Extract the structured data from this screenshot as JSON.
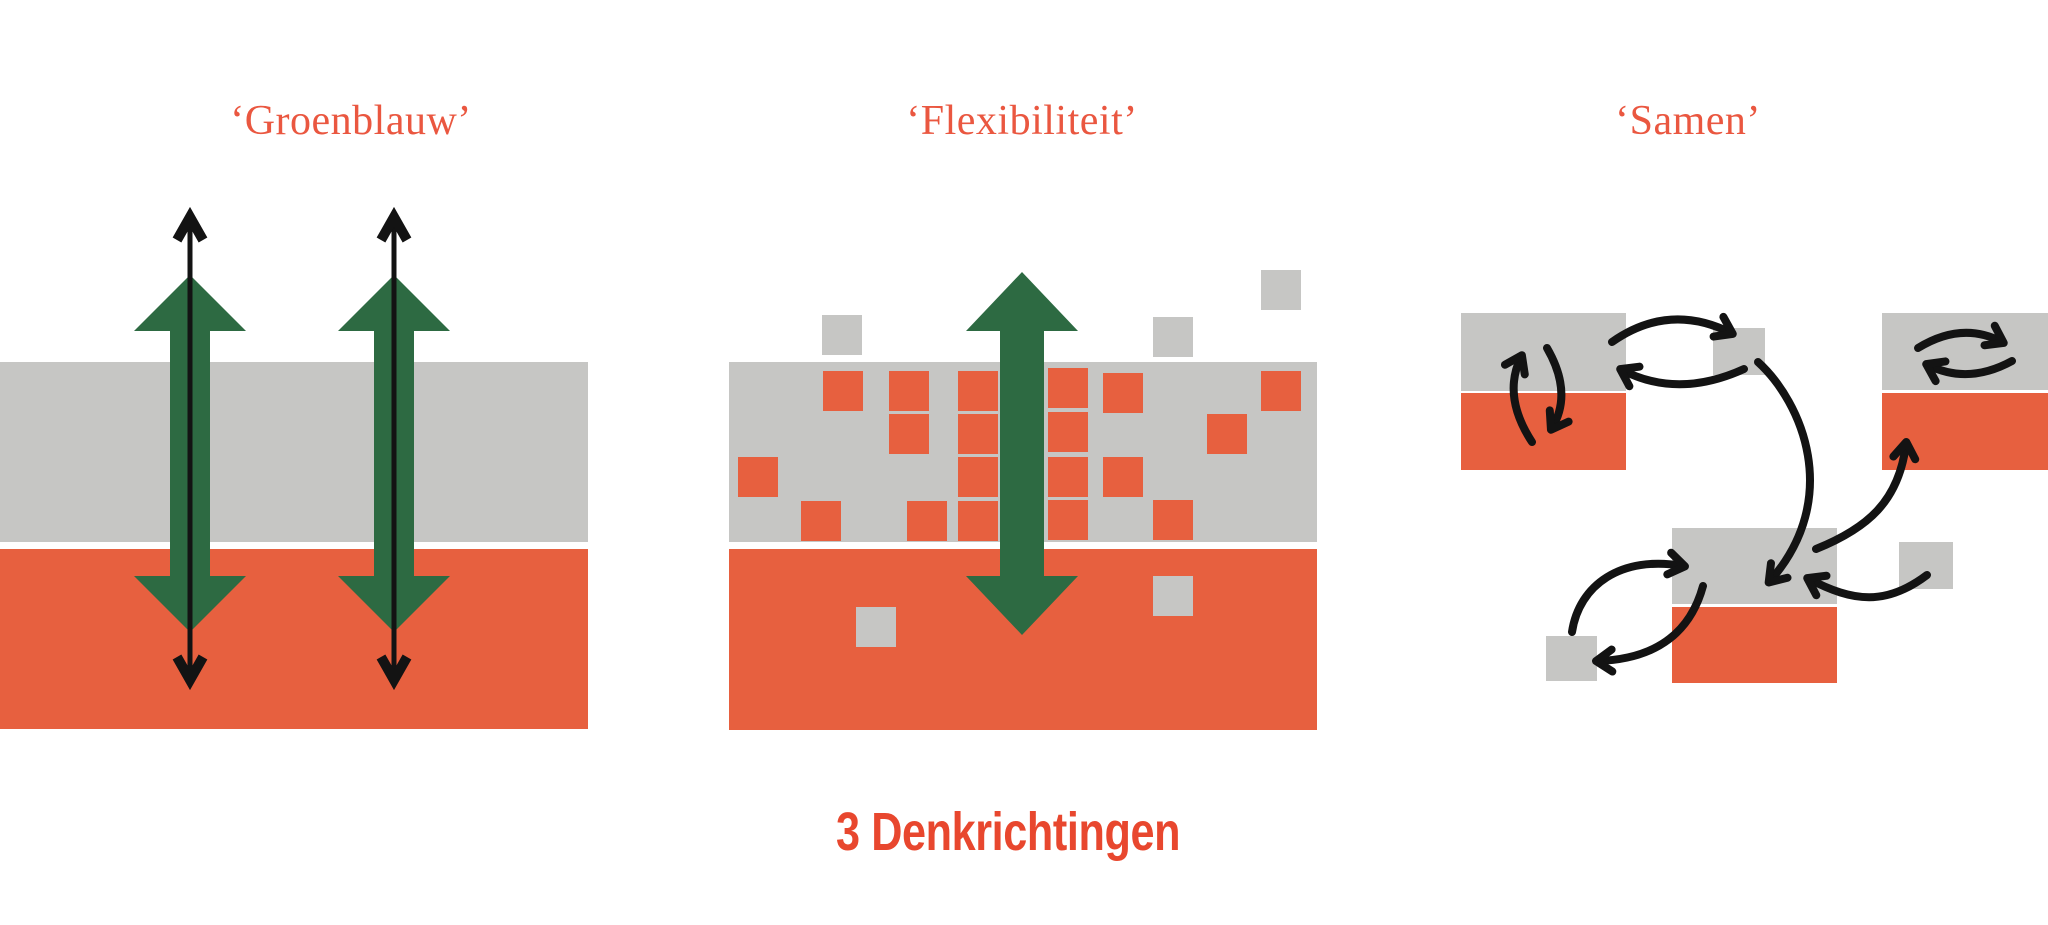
{
  "title": "3 Denkrichtingen",
  "panels": {
    "groenblauw": {
      "label": "‘Groenblauw’"
    },
    "flexibiliteit": {
      "label": "‘Flexibiliteit’"
    },
    "samen": {
      "label": "‘Samen’"
    }
  },
  "colors": {
    "background": "#ffffff",
    "gray": "#c6c6c4",
    "orange": "#e7603f",
    "green": "#2d6a42",
    "black": "#131313",
    "label_text": "#ea5740",
    "title_text": "#e8472e"
  },
  "groenblauw": {
    "bands": {
      "gray": {
        "x": 0,
        "y": 362,
        "w": 588,
        "h": 180
      },
      "orange": {
        "x": 0,
        "y": 549,
        "w": 588,
        "h": 180
      }
    },
    "updown_arrow_centers": [
      190,
      394
    ]
  },
  "flexibiliteit": {
    "bands": {
      "gray": {
        "x": 729,
        "y": 362,
        "w": 588,
        "h": 180
      },
      "orange": {
        "x": 729,
        "y": 549,
        "w": 588,
        "h": 181
      }
    },
    "square_size": 40,
    "gray_squares_above": [
      [
        822,
        315
      ],
      [
        1153,
        317
      ],
      [
        1261,
        270
      ]
    ],
    "orange_squares_in_gray_band": [
      [
        823,
        371
      ],
      [
        889,
        371
      ],
      [
        958,
        371
      ],
      [
        1048,
        368
      ],
      [
        1103,
        373
      ],
      [
        1261,
        371
      ],
      [
        889,
        414
      ],
      [
        958,
        414
      ],
      [
        1048,
        412
      ],
      [
        1207,
        414
      ],
      [
        738,
        457
      ],
      [
        958,
        457
      ],
      [
        1048,
        457
      ],
      [
        1103,
        457
      ],
      [
        801,
        501
      ],
      [
        907,
        501
      ],
      [
        958,
        501
      ],
      [
        1048,
        500
      ],
      [
        1153,
        500
      ]
    ],
    "gray_squares_in_orange_band": [
      [
        856,
        607
      ],
      [
        1153,
        576
      ]
    ],
    "big_arrow_center": 1022
  },
  "samen": {
    "blocks": [
      {
        "name": "block1-gray",
        "x": 1461,
        "y": 313,
        "w": 165,
        "h": 78,
        "color": "gray"
      },
      {
        "name": "block1-orange",
        "x": 1461,
        "y": 393,
        "w": 165,
        "h": 77,
        "color": "orange"
      },
      {
        "name": "square2",
        "x": 1713,
        "y": 328,
        "w": 52,
        "h": 47,
        "color": "gray"
      },
      {
        "name": "block3-gray",
        "x": 1882,
        "y": 313,
        "w": 166,
        "h": 77,
        "color": "gray"
      },
      {
        "name": "block3-orange",
        "x": 1882,
        "y": 393,
        "w": 166,
        "h": 77,
        "color": "orange"
      },
      {
        "name": "block4-gray",
        "x": 1672,
        "y": 528,
        "w": 165,
        "h": 76,
        "color": "gray"
      },
      {
        "name": "block4-orange",
        "x": 1672,
        "y": 607,
        "w": 165,
        "h": 76,
        "color": "orange"
      },
      {
        "name": "square5",
        "x": 1546,
        "y": 636,
        "w": 51,
        "h": 45,
        "color": "gray"
      },
      {
        "name": "square6",
        "x": 1899,
        "y": 542,
        "w": 54,
        "h": 47,
        "color": "gray"
      }
    ],
    "connections": [
      {
        "type": "cycle",
        "between": [
          "block1-gray",
          "block1-orange"
        ]
      },
      {
        "type": "cycle",
        "between": [
          "block1-gray",
          "square2"
        ]
      },
      {
        "type": "cycle",
        "between": [
          "block3-gray",
          "block3-gray"
        ]
      },
      {
        "type": "arrow",
        "from": "square2",
        "to": "block4-gray"
      },
      {
        "type": "arrow",
        "from": "block4-gray",
        "to": "block3-orange"
      },
      {
        "type": "cycle",
        "between": [
          "square5",
          "block4-gray"
        ]
      },
      {
        "type": "arrow",
        "from": "square6",
        "to": "block4-gray"
      }
    ]
  }
}
